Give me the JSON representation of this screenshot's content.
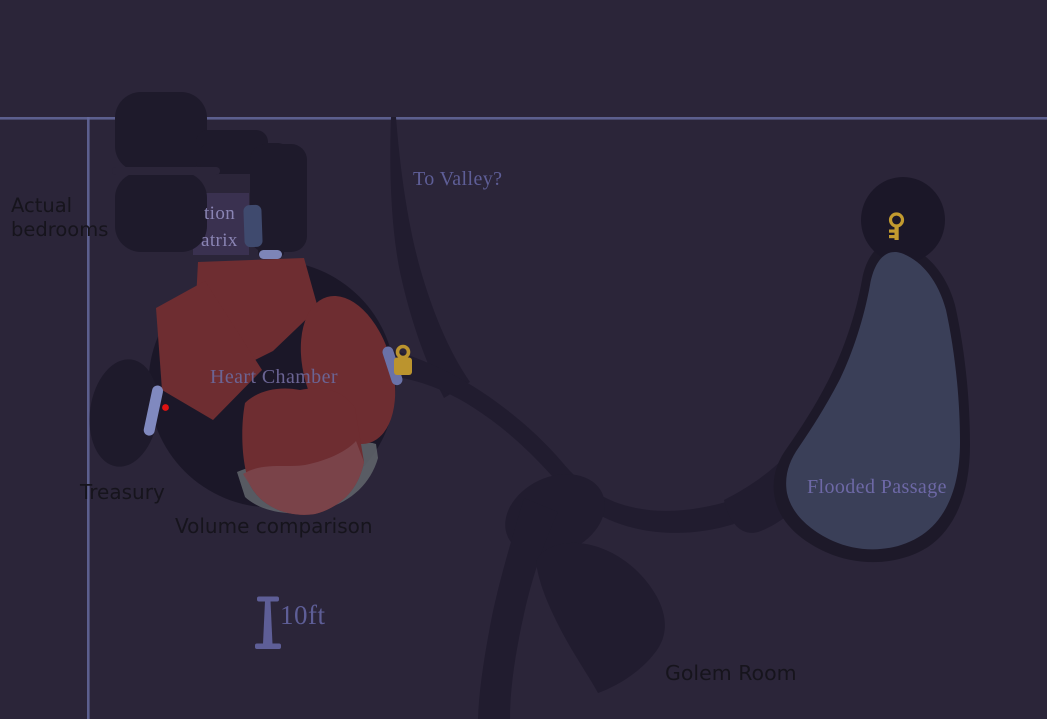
{
  "regions": {
    "heart_chamber": "Heart Chamber",
    "treasury": "Treasury",
    "flooded_passage": "Flooded Passage",
    "golem_room": "Golem Room",
    "to_valley": "To Valley?",
    "hidden_room_fragment_line1": "tion",
    "hidden_room_fragment_line2": "atrix"
  },
  "notes": {
    "actual_bedrooms_line1": "Actual",
    "actual_bedrooms_line2": "bedrooms",
    "volume_comparison": "Volume comparison"
  },
  "scale": {
    "label": "10ft"
  },
  "markers": {
    "lock": "padlock-icon",
    "key": "key-icon",
    "red_dot": "red-dot-marker",
    "door": "door-marker"
  },
  "colors": {
    "background": "#2b2539",
    "cave_passage": "#211c2f",
    "cave_room": "#1b1728",
    "bedrooms_blob": "#1e1a2b",
    "ruled_line": "#656a9e",
    "heart_red": "#6e2d31",
    "heart_red_light": "#7a454b",
    "gray_blob": "#62666c",
    "flooded_water": "#3a3f58",
    "door_light": "#8089bf",
    "door_mid": "#6a72a8",
    "door_dark": "#3f4a6e",
    "gold": "#bb942e",
    "red_dot": "#e01212",
    "label_purple": "#5e5e97",
    "label_black": "#16141c",
    "hidden_panel": "#3a3150"
  }
}
